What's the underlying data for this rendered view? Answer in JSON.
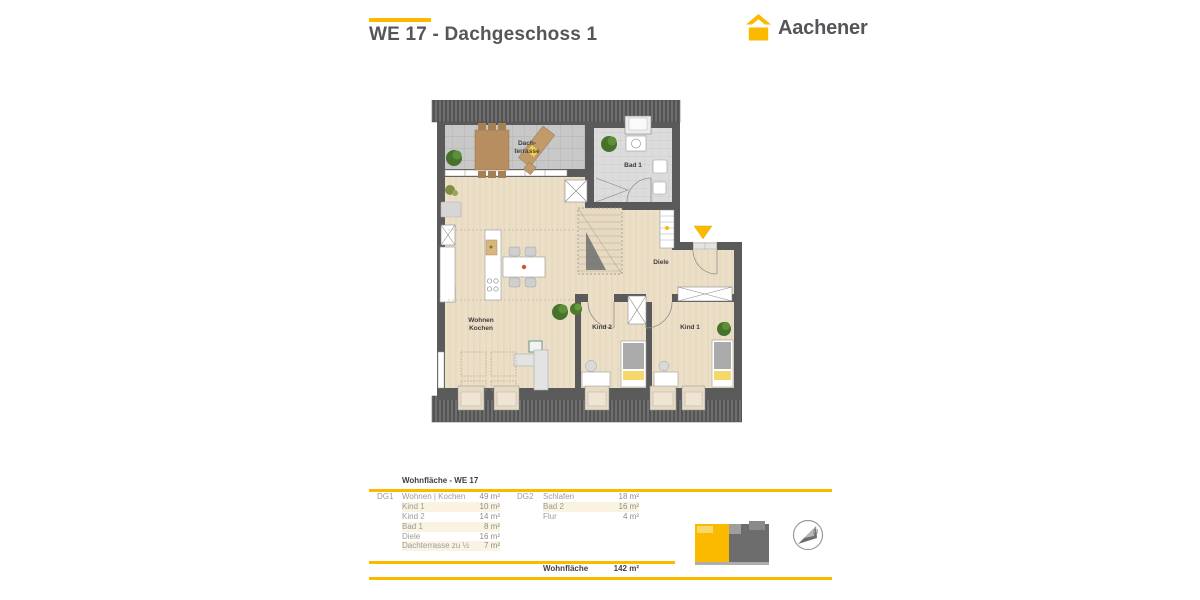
{
  "brand": {
    "name": "Aachener",
    "accent_color": "#FBBA00"
  },
  "header": {
    "title": "WE 17 - Dachgeschoss 1"
  },
  "floorplan": {
    "labels": {
      "terrace_line1": "Dach-",
      "terrace_line2": "terrasse",
      "bad1": "Bad 1",
      "diele": "Diele",
      "wohnen_line1": "Wohnen",
      "wohnen_line2": "Kochen",
      "kind2": "Kind 2",
      "kind1": "Kind 1"
    },
    "entrance_marker_color": "#FBBA00"
  },
  "area_table": {
    "title": "Wohnfläche - WE 17",
    "groups": [
      {
        "label": "DG1",
        "rows": [
          {
            "room": "Wohnen | Kochen",
            "area": "49 m²"
          },
          {
            "room": "Kind 1",
            "area": "10 m²"
          },
          {
            "room": "Kind 2",
            "area": "14 m²"
          },
          {
            "room": "Bad 1",
            "area": "8 m²"
          },
          {
            "room": "Diele",
            "area": "16 m²"
          },
          {
            "room": "Dachterrasse zu ½",
            "area": "7 m²"
          }
        ]
      },
      {
        "label": "DG2",
        "rows": [
          {
            "room": "Schlafen",
            "area": "18 m²"
          },
          {
            "room": "Bad 2",
            "area": "16 m²"
          },
          {
            "room": "Flur",
            "area": "4 m²"
          }
        ]
      }
    ],
    "total_label": "Wohnfläche",
    "total_value": "142 m²",
    "compass_letter": "N"
  }
}
